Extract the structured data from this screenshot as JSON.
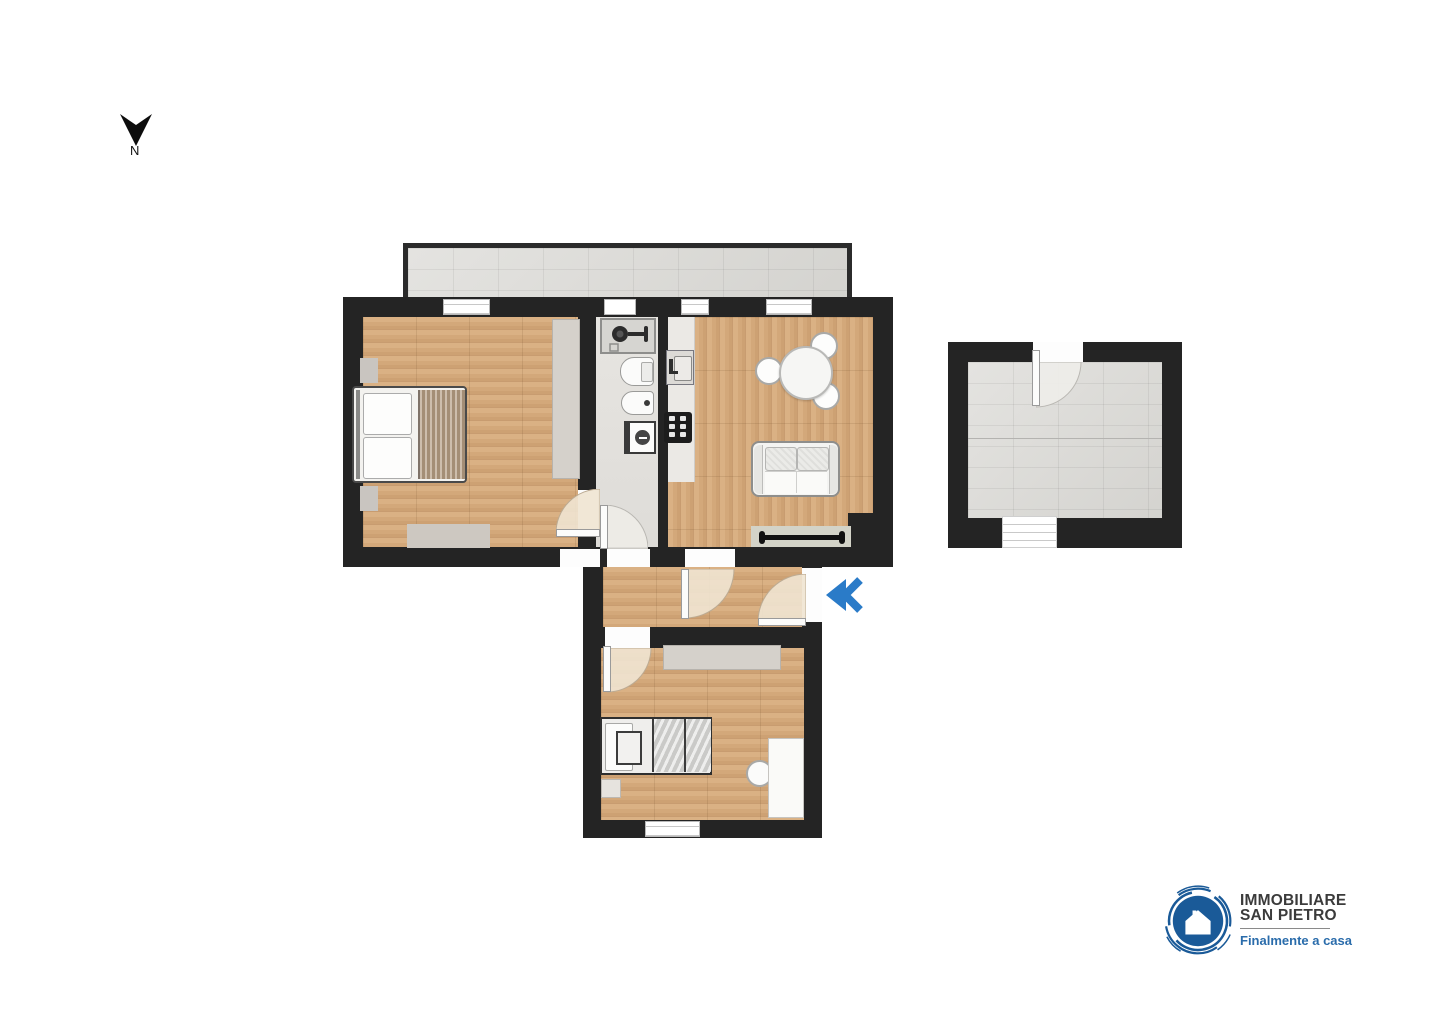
{
  "compass": {
    "label": "N",
    "icon": "north-arrow"
  },
  "entrance": {
    "icon": "double-chevron-left",
    "direction": "left",
    "color": "#2a7bc8"
  },
  "logo": {
    "name_line1": "IMMOBILIARE",
    "name_line2": "SAN PIETRO",
    "tagline": "Finalmente a casa",
    "icon": "house-in-circle",
    "brand_color": "#1a5a98",
    "name_color": "#3b3b3b",
    "tagline_color": "#2a6cab"
  },
  "palette": {
    "wall": "#242424",
    "wood_floor": "#d5aa7e",
    "tile_floor": "#dbdad6",
    "bath_floor": "#e4e2de",
    "accent_blue": "#2a7bc8"
  }
}
